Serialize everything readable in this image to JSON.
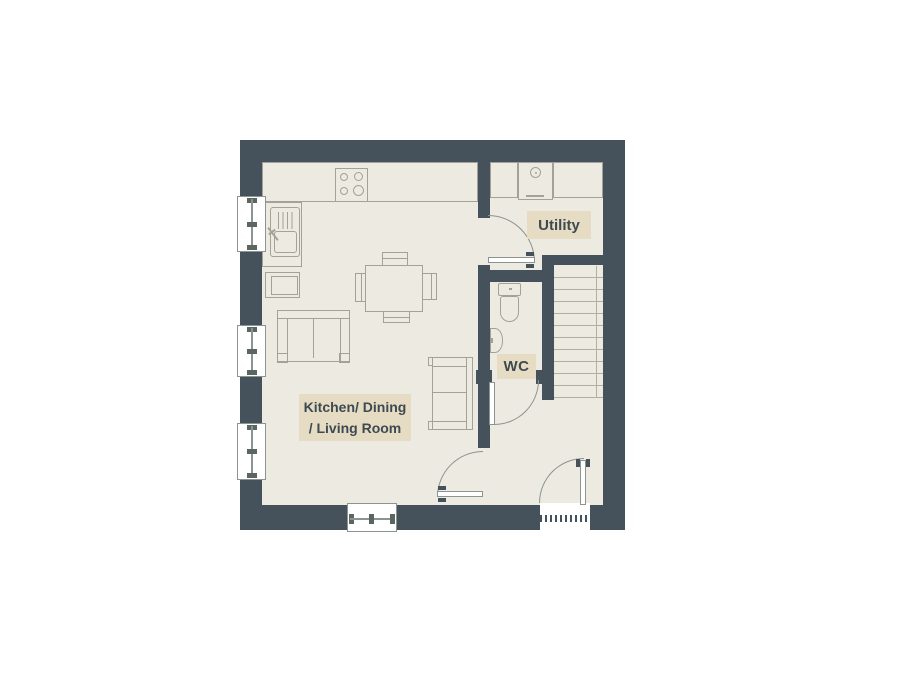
{
  "title": "Ground floor plan",
  "rooms": {
    "main": {
      "label_line1": "Kitchen/ Dining",
      "label_line2": "/ Living Room"
    },
    "utility": {
      "label": "Utility"
    },
    "wc": {
      "label": "WC"
    }
  },
  "fixtures": [
    "kitchen-counter",
    "hob",
    "sink",
    "base-unit",
    "dining-table",
    "dining-chairs",
    "sofa",
    "loveseat",
    "utility-counter",
    "washing-machine",
    "toilet",
    "basin",
    "stairs",
    "windows",
    "doors",
    "front-door-threshold"
  ],
  "colors": {
    "wall": "#45525b",
    "floor": "#edeae1",
    "label_bg": "#e6dcc3",
    "label_text": "#3e4a52",
    "furniture_line": "#a2a298",
    "door_line": "#8b948e",
    "sash": "#5a665f",
    "stair_line": "#b3aea1"
  }
}
